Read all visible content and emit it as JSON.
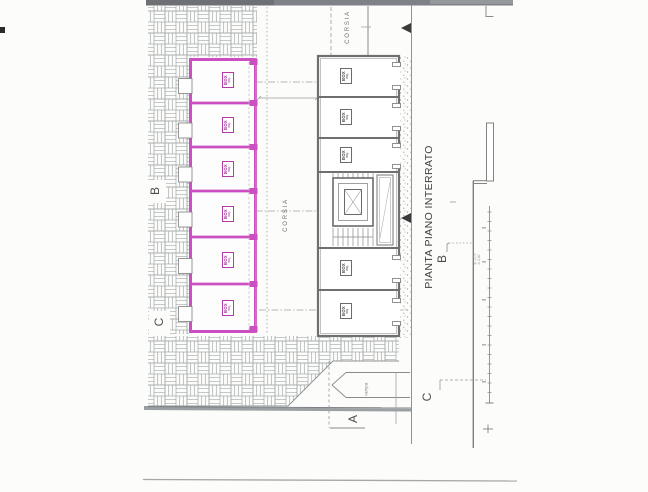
{
  "title": "PIANTA PIANO INTERRATO",
  "labels": {
    "corsia_top": "CORSIA",
    "corsia_center": "CORSIA",
    "rampa": "rampa"
  },
  "section_markers": {
    "plan_b": "B",
    "plan_c": "C",
    "plan_a": "A",
    "profile_b": "B",
    "profile_c": "C"
  },
  "left_units": [
    {
      "line1": "BOX",
      "line2": "mq."
    },
    {
      "line1": "BOX",
      "line2": "mq."
    },
    {
      "line1": "BOX",
      "line2": "mq."
    },
    {
      "line1": "BOX",
      "line2": "mq."
    },
    {
      "line1": "BOX",
      "line2": "mq."
    },
    {
      "line1": "BOX",
      "line2": "mq."
    }
  ],
  "right_units": [
    {
      "line1": "BOX",
      "line2": "mq."
    },
    {
      "line1": "BOX",
      "line2": "mq."
    },
    {
      "line1": "BOX",
      "line2": "mq."
    },
    {
      "line1": "BOX",
      "line2": "mq."
    },
    {
      "line1": "BOX",
      "line2": "mq."
    }
  ],
  "section_note": {
    "line1": "q. -2,75",
    "line2": "h. 2,40"
  },
  "colors": {
    "highlight": "#cb4fc0",
    "linework": "#6f6f6f",
    "hatch": "#9ba0a0"
  }
}
